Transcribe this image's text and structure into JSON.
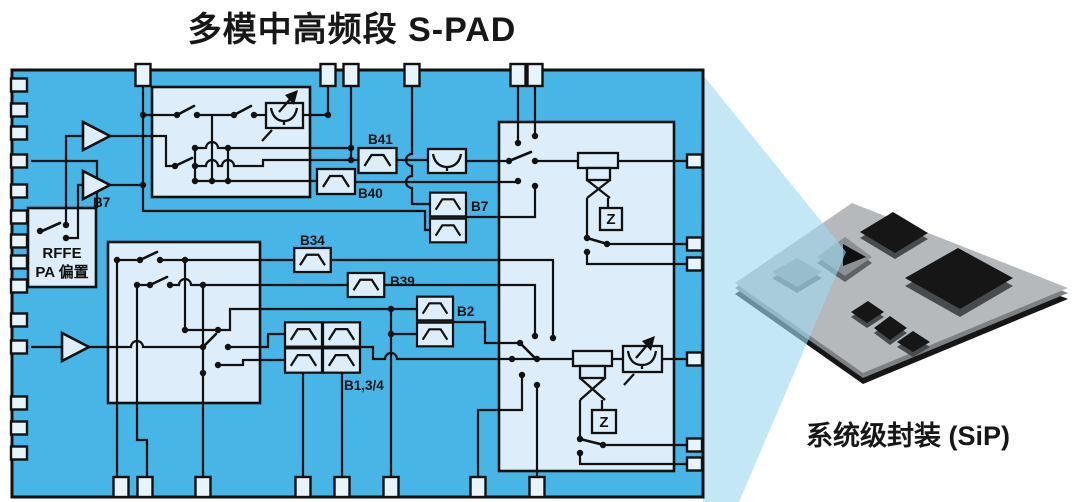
{
  "title": "多模中高频段 S-PAD",
  "sip": {
    "label": "系统级封装 (SiP)"
  },
  "schematic": {
    "rffe_block": {
      "line1": "RFFE",
      "line2": "PA 偏置"
    },
    "amplifier_label": "B7",
    "impedance_label_1": "Z",
    "impedance_label_2": "Z",
    "filters": {
      "b41": "B41",
      "b40": "B40",
      "b7_duplexer": "B7",
      "b34": "B34",
      "b39": "B39",
      "b2": "B2",
      "b1_3_4": "B1,3/4"
    }
  },
  "colors": {
    "board": "#47b5e6",
    "block": "#ddeefa",
    "pad": "#e8f4fc",
    "wire": "#111111",
    "beam": "#9fd8f1",
    "sip_board": "#b6b9bb",
    "sip_rim": "#7d8184",
    "sip_base": "#161616",
    "chip": "#161616",
    "chip_side": "#474b4e",
    "chip_gray": "#8b9094",
    "chip_gray_side": "#5e6265"
  }
}
